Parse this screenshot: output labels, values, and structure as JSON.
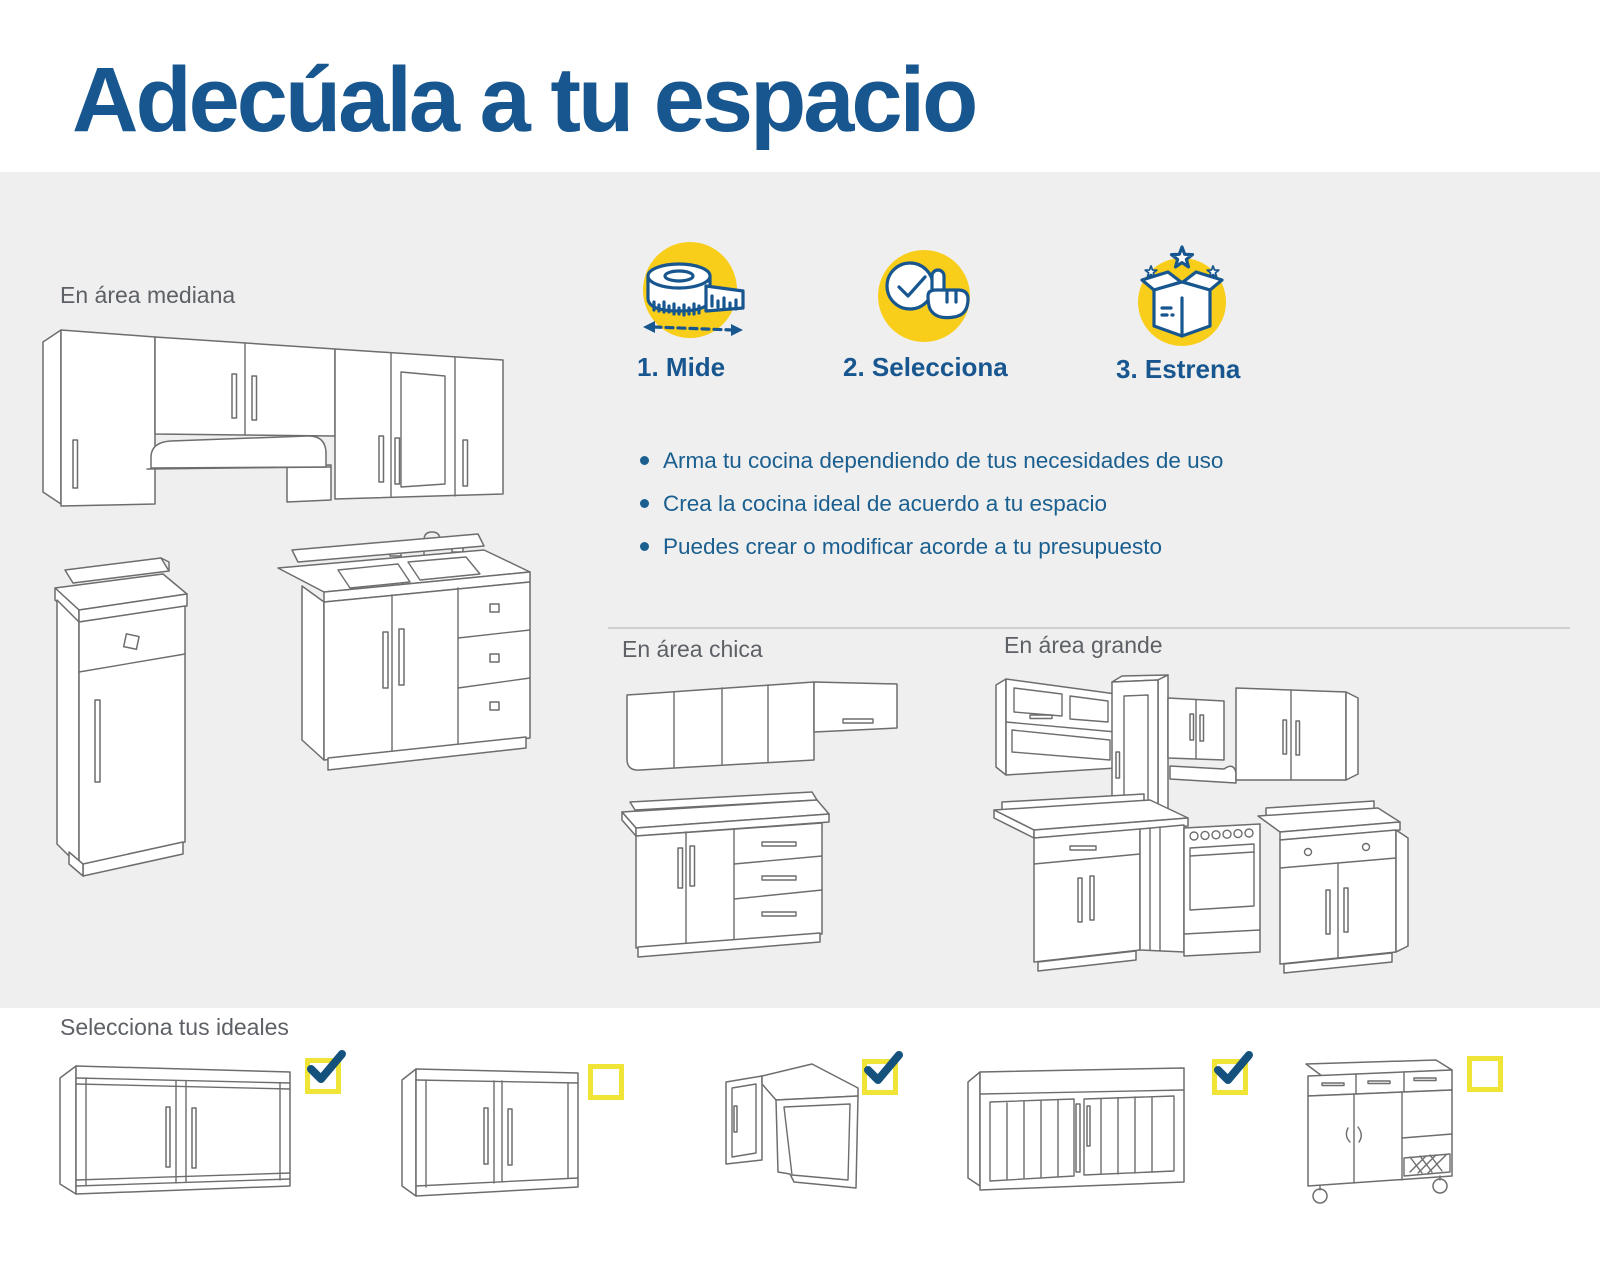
{
  "page": {
    "title": "Adecúala a tu espacio"
  },
  "colors": {
    "accent_blue": "#17568F",
    "text_blue": "#1A5F8F",
    "label_gray": "#5D6166",
    "band_gray": "#EFEFEF",
    "icon_yellow": "#F8CE1B",
    "checkbox_yellow": "#F0E437",
    "check_blue": "#14527D"
  },
  "sections": {
    "medium": {
      "label": "En área mediana"
    },
    "small": {
      "label": "En área chica"
    },
    "large": {
      "label": "En área grande"
    }
  },
  "steps": [
    {
      "label": "1. Mide",
      "icon": "measuring-tape-icon"
    },
    {
      "label": "2. Selecciona",
      "icon": "select-check-hand-icon"
    },
    {
      "label": "3. Estrena",
      "icon": "gift-box-stars-icon"
    }
  ],
  "benefits": [
    "Arma tu cocina dependiendo de tus necesidades de uso",
    "Crea la cocina ideal de acuerdo a tu espacio",
    "Puedes crear o modificar acorde a tu presupuesto"
  ],
  "selector": {
    "label": "Selecciona tus ideales",
    "items": [
      {
        "name": "wall-cabinet-two-glass-doors-wide",
        "checked": true
      },
      {
        "name": "wall-cabinet-two-glass-doors",
        "checked": false
      },
      {
        "name": "corner-wall-cabinet",
        "checked": true
      },
      {
        "name": "cabinet-two-slatted-doors",
        "checked": true
      },
      {
        "name": "base-cabinet-with-shelf-and-casters",
        "checked": false
      }
    ]
  }
}
